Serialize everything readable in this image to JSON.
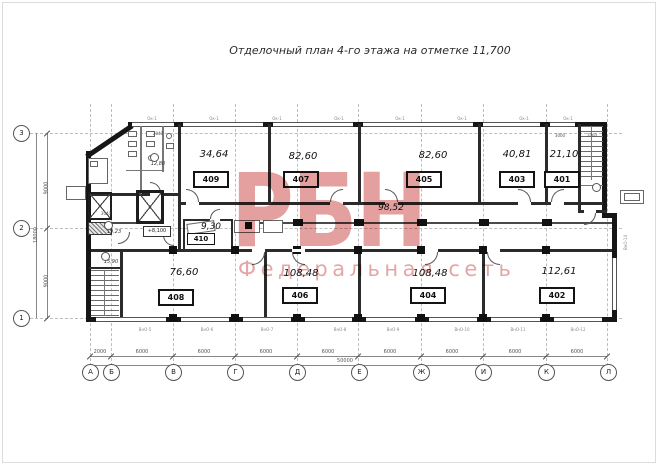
{
  "title": "Отделочный план 4-го этажа на отметке 11,700",
  "watermark": {
    "logo": "РБН",
    "tagline": "Федеральная сеть",
    "color": "#d05a5a"
  },
  "rooms": [
    {
      "number": "409",
      "area": "34,64"
    },
    {
      "number": "407",
      "area": "82,60"
    },
    {
      "number": "405",
      "area": "82,60"
    },
    {
      "number": "403",
      "area": "40,81"
    },
    {
      "number": "401",
      "area": "21,10"
    },
    {
      "number": "410",
      "area": "9,30"
    },
    {
      "number": "408",
      "area": "76,60"
    },
    {
      "number": "406",
      "area": "108,48"
    },
    {
      "number": "404",
      "area": "108,48"
    },
    {
      "number": "402",
      "area": "112,61"
    }
  ],
  "corridor": {
    "area": "98,52"
  },
  "small_areas": {
    "wc": "12,80",
    "lobby": "19,23",
    "stair": "15,90",
    "level_mark": "+8,100"
  },
  "axes": {
    "bottom": [
      "А",
      "Б",
      "В",
      "Г",
      "Д",
      "Е",
      "Ж",
      "И",
      "К",
      "Л"
    ],
    "left": [
      "3",
      "2",
      "1"
    ]
  },
  "dimensions": {
    "bottom_segments": [
      "2000",
      "6000",
      "6000",
      "6000",
      "6000",
      "6000",
      "6000",
      "6000",
      "6000"
    ],
    "bottom_total": "50000",
    "left_segments": [
      "9000",
      "9000"
    ],
    "left_total": "18000",
    "micro": [
      "2040",
      "3040",
      "3000",
      "2060"
    ]
  },
  "labels": {
    "window_bottom": [
      "ВнО-5",
      "ВнО-6",
      "ВнО-7",
      "ВнО-8",
      "ВнО-9",
      "ВнО-10",
      "ВнО-11",
      "ВнО-12"
    ],
    "window_right": "ВнО-14",
    "window_top": "Ок-1"
  }
}
